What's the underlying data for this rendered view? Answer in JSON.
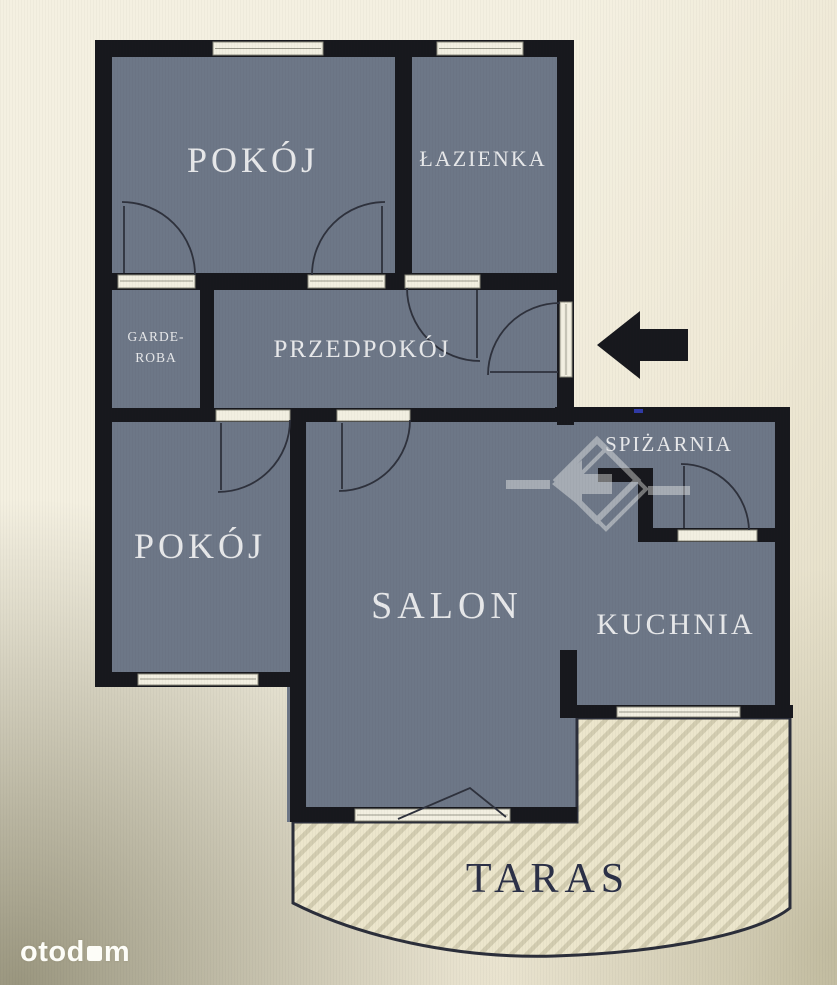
{
  "plan": {
    "rooms": {
      "pokoj_top": "POKÓJ",
      "lazienka": "ŁAZIENKA",
      "garderoba_line1": "GARDE-",
      "garderoba_line2": "ROBA",
      "przedpokoj": "PRZEDPOKÓJ",
      "pokoj_left": "POKÓJ",
      "salon": "SALON",
      "spizarnia": "SPIŻARNIA",
      "kuchnia": "KUCHNIA",
      "taras": "TARAS"
    },
    "colors": {
      "wall": "#17181d",
      "room_fill": "#6d7787",
      "room_label": "#e7e8ea",
      "taras_label": "#2b3047",
      "terrace_fill": "#ece6cc",
      "terrace_stripe": "#d2ccb0",
      "window_fill": "#f2efe1",
      "background_cream": "#f0ebd9",
      "entry_arrow": "#17181d",
      "watermark": "#f5f5f2"
    }
  },
  "branding": {
    "site_prefix": "otod",
    "site_suffix": "m"
  }
}
